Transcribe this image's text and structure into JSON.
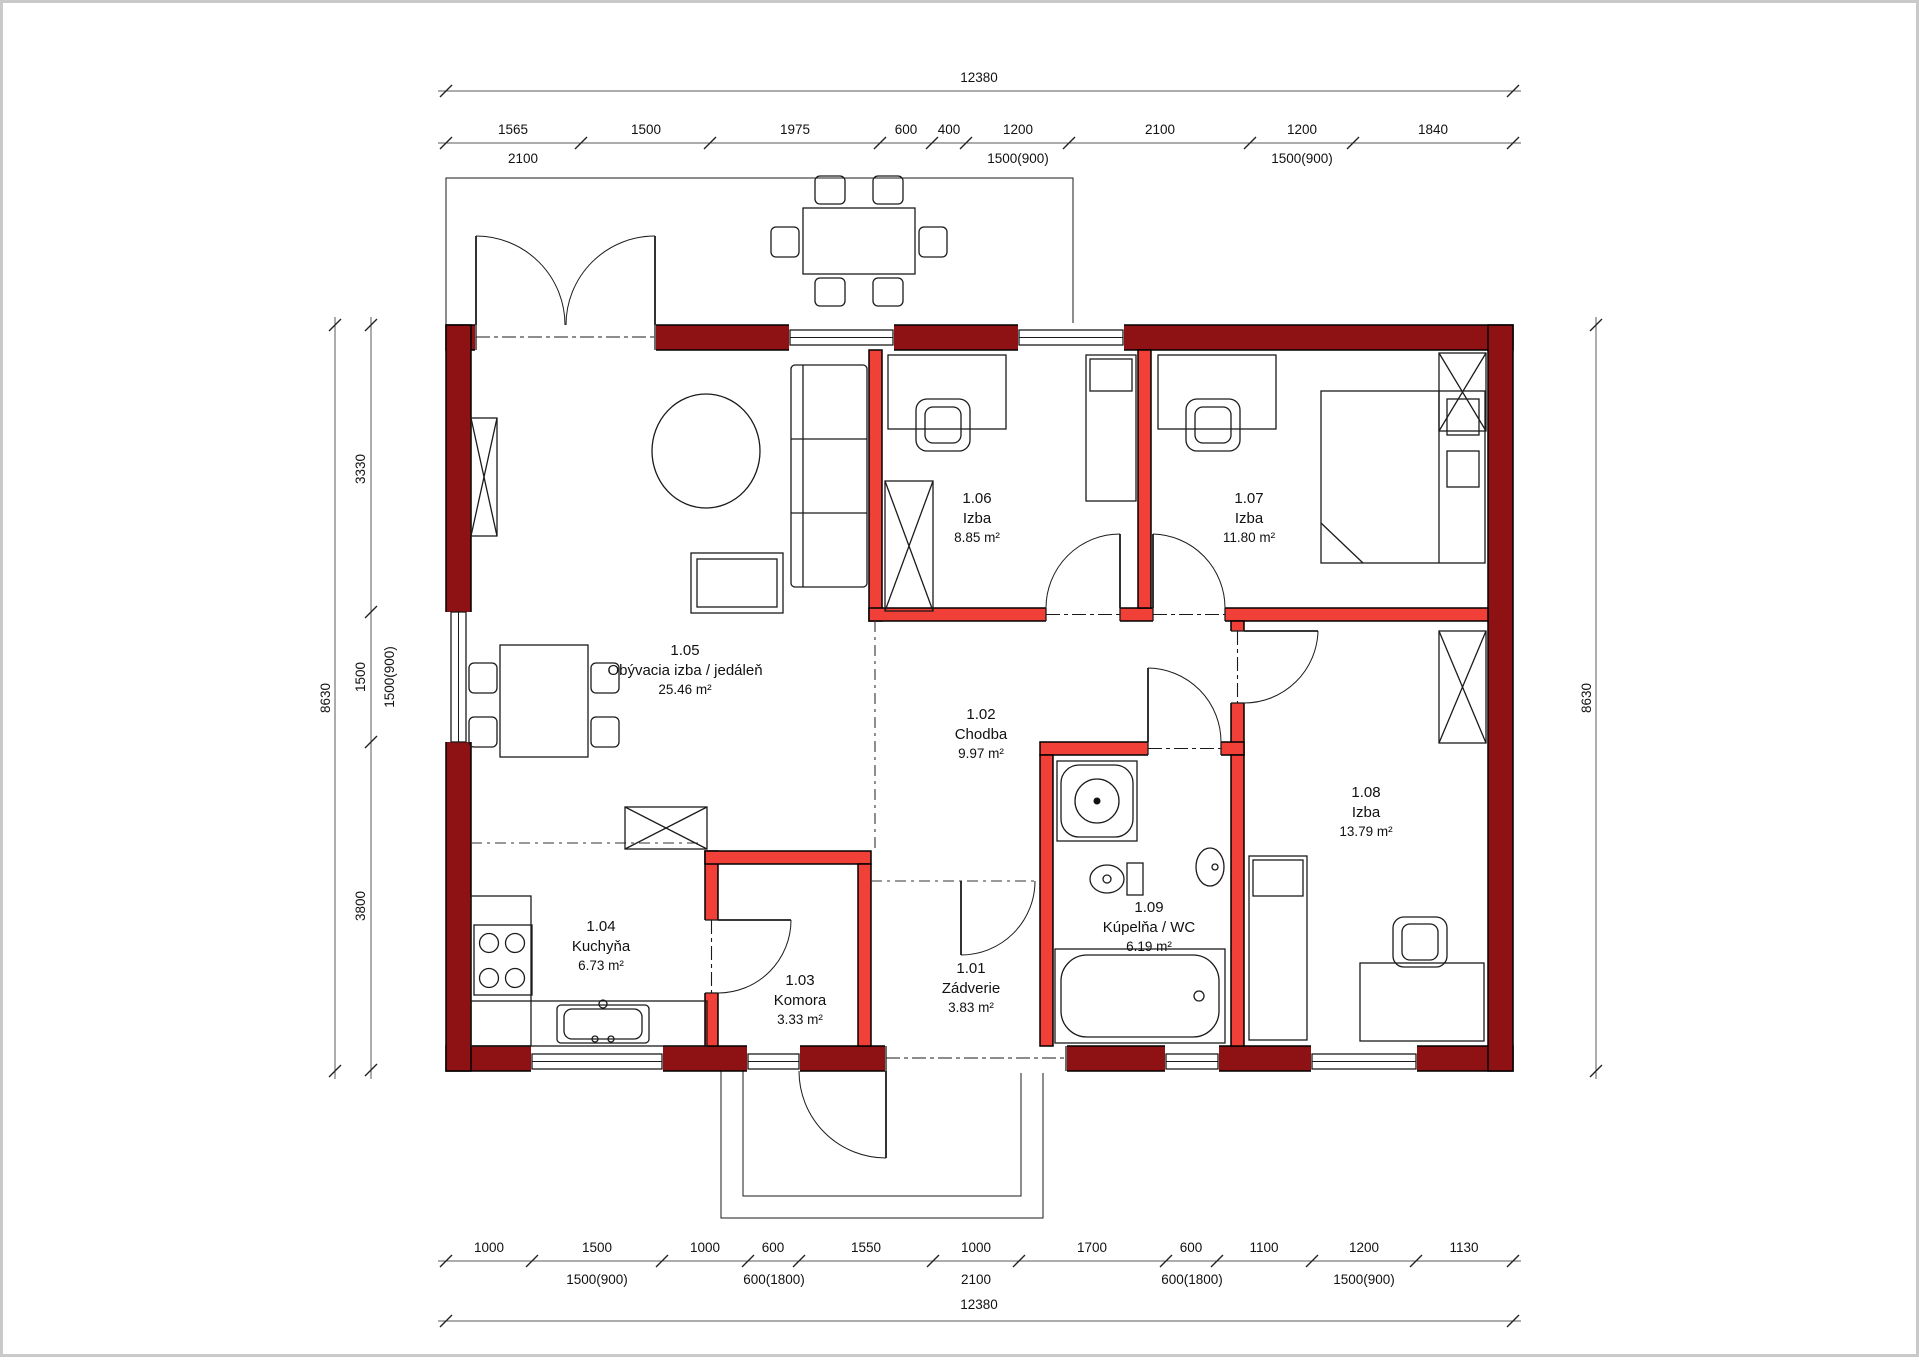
{
  "drawing": {
    "kind": "floor-plan"
  },
  "colors": {
    "exterior_wall": "#8e1113",
    "interior_wall": "#f04038",
    "line": "#1b1b1b"
  },
  "rooms": [
    {
      "id": "1.01",
      "name": "Zádverie",
      "area": "3.83 m²"
    },
    {
      "id": "1.02",
      "name": "Chodba",
      "area": "9.97 m²"
    },
    {
      "id": "1.03",
      "name": "Komora",
      "area": "3.33 m²"
    },
    {
      "id": "1.04",
      "name": "Kuchyňa",
      "area": "6.73 m²"
    },
    {
      "id": "1.05",
      "name": "Obývacia izba / jedáleň",
      "area": "25.46 m²"
    },
    {
      "id": "1.06",
      "name": "Izba",
      "area": "8.85 m²"
    },
    {
      "id": "1.07",
      "name": "Izba",
      "area": "11.80 m²"
    },
    {
      "id": "1.08",
      "name": "Izba",
      "area": "13.79 m²"
    },
    {
      "id": "1.09",
      "name": "Kúpelňa / WC",
      "area": "6.19 m²"
    }
  ],
  "dims": {
    "top": {
      "total": "12380",
      "row2": [
        "1565",
        "1500",
        "1975",
        "600",
        "400",
        "1200",
        "2100",
        "1200",
        "1840"
      ],
      "row3": [
        "2100",
        "1500(900)",
        "1500(900)"
      ]
    },
    "bottom": {
      "row1": [
        "1000",
        "1500",
        "1000",
        "600",
        "1550",
        "1000",
        "1700",
        "600",
        "1100",
        "1200",
        "1130"
      ],
      "row2": [
        "1500(900)",
        "600(1800)",
        "2100",
        "600(1800)",
        "1500(900)"
      ],
      "total": "12380"
    },
    "left": {
      "total": "8630",
      "segments": [
        "3330",
        "1500",
        "3800"
      ],
      "secondary": "1500(900)"
    },
    "right": {
      "total": "8630"
    }
  }
}
